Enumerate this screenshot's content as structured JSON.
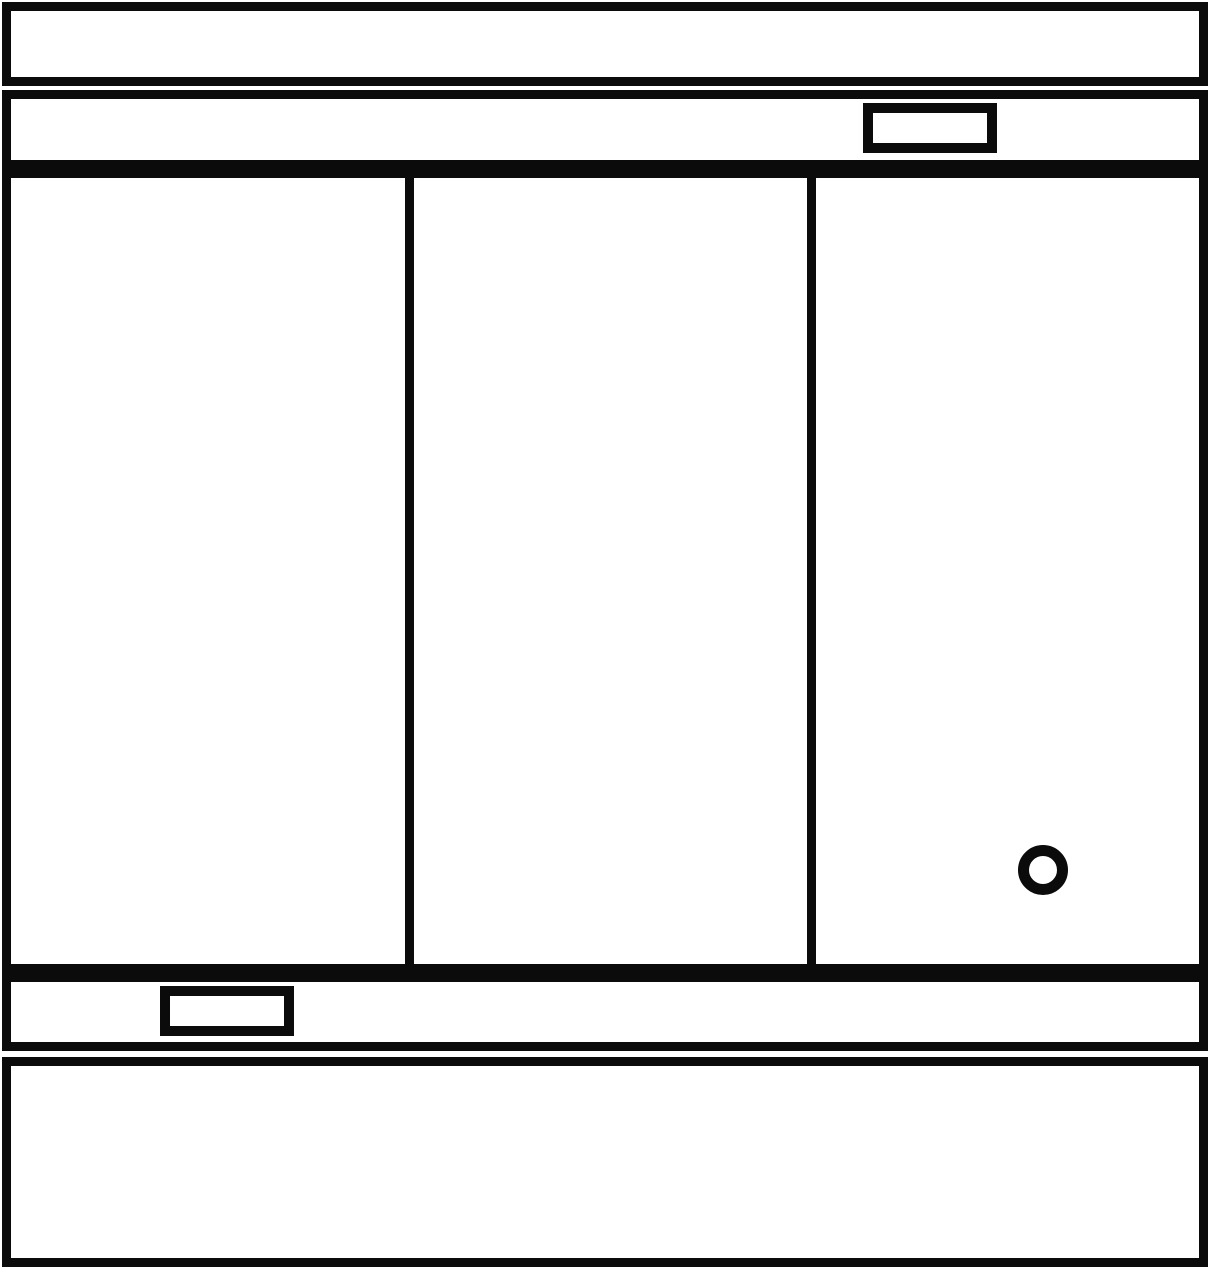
{
  "diagram": {
    "kind": "monochrome line drawing — appliance front elevation",
    "stroke_color": "#0b0b0b",
    "background_color": "#ffffff",
    "text_content": "",
    "parts": {
      "top_panel": "top-panel",
      "control_panel": "control-panel-band",
      "control_badge": "small-rectangle-badge-right",
      "door_left": "left-door-panel",
      "door_center": "center-door-panel",
      "door_right": "right-door-panel",
      "knob": "round-knob-ring",
      "kick_panel": "lower-band",
      "kick_badge": "small-rectangle-badge-left",
      "base_panel": "bottom-base-section"
    }
  }
}
